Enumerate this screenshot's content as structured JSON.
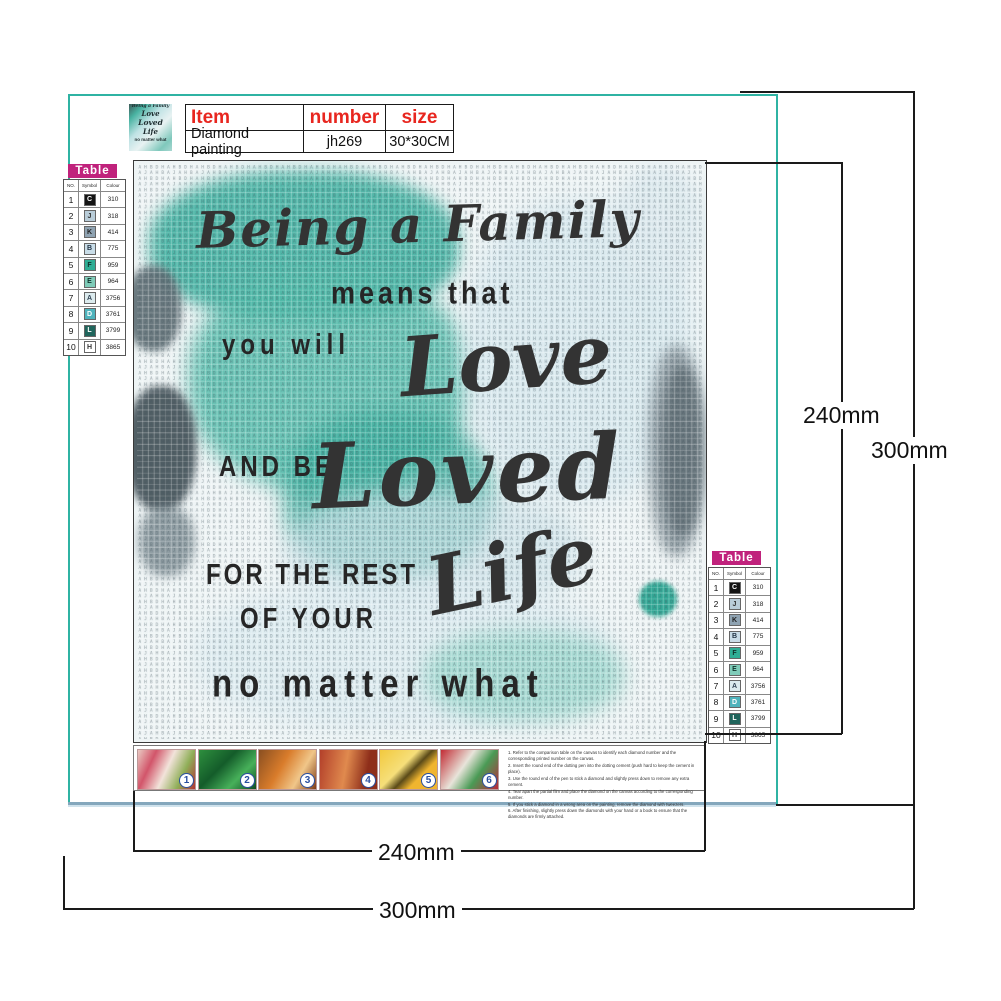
{
  "header_table": {
    "columns": [
      "Item",
      "number",
      "size"
    ],
    "row": {
      "item": "Diamond painting",
      "number": "jh269",
      "size": "30*30CM"
    }
  },
  "color_table": {
    "title": "Table",
    "columns": [
      "NO.",
      "Symbol",
      "Colour"
    ],
    "rows": [
      {
        "no": "1",
        "symbol": "C",
        "colour": "310",
        "bg": "#141414",
        "fg": "#ffffff"
      },
      {
        "no": "2",
        "symbol": "J",
        "colour": "318",
        "bg": "#b9cdd9",
        "fg": "#333333"
      },
      {
        "no": "3",
        "symbol": "K",
        "colour": "414",
        "bg": "#8fa3b2",
        "fg": "#222222"
      },
      {
        "no": "4",
        "symbol": "B",
        "colour": "775",
        "bg": "#c9dde8",
        "fg": "#223344"
      },
      {
        "no": "5",
        "symbol": "F",
        "colour": "959",
        "bg": "#2fae95",
        "fg": "#10332c"
      },
      {
        "no": "6",
        "symbol": "E",
        "colour": "964",
        "bg": "#7fccb9",
        "fg": "#10332c"
      },
      {
        "no": "7",
        "symbol": "A",
        "colour": "3756",
        "bg": "#dcebee",
        "fg": "#334455"
      },
      {
        "no": "8",
        "symbol": "D",
        "colour": "3761",
        "bg": "#4fb3bc",
        "fg": "#ffffff"
      },
      {
        "no": "9",
        "symbol": "L",
        "colour": "3799",
        "bg": "#20655c",
        "fg": "#ffffff"
      },
      {
        "no": "10",
        "symbol": "H",
        "colour": "3865",
        "bg": "#ffffff",
        "fg": "#333333"
      }
    ]
  },
  "canvas": {
    "quote": {
      "line1": "Being a Family",
      "line2": "means that",
      "line3": "you will",
      "line4": "Love",
      "line5": "AND BE",
      "line6": "Loved",
      "line7": "FOR THE REST",
      "line8": "OF YOUR",
      "line9": "Life",
      "line10": "no matter what"
    },
    "texture_letters": [
      "A",
      "H",
      "B",
      "D",
      "H",
      "A",
      "J",
      "A",
      "H",
      "B"
    ]
  },
  "instructions": {
    "steps": [
      "1",
      "2",
      "3",
      "4",
      "5",
      "6"
    ],
    "lines": [
      "1. Refer to the comparison table on the canvas to identify each diamond number and the corresponding printed number on the canvas.",
      "2. Insert the round end of the dotting pen into the dotting cement (push hard to keep the cement in place).",
      "3. Use the round end of the pen to stick a diamond and slightly press down to remove any extra cement.",
      "4. Tear apart the partial film and place the diamond on the canvas according to the corresponding number.",
      "5. If you stick a diamond in a wrong area on the painting, remove the diamond with tweezers.",
      "6. After finishing, slightly press down the diamonds with your hand or a book to ensure that the diamonds are firmly attached."
    ]
  },
  "dimensions": {
    "inner_height": "240mm",
    "outer_height": "300mm",
    "inner_width": "240mm",
    "outer_width": "300mm"
  },
  "colors": {
    "accent_teal": "#2fb3a3",
    "badge_magenta": "#c0227c",
    "header_red": "#e8261f",
    "step_number_blue": "#2a4fa0"
  }
}
